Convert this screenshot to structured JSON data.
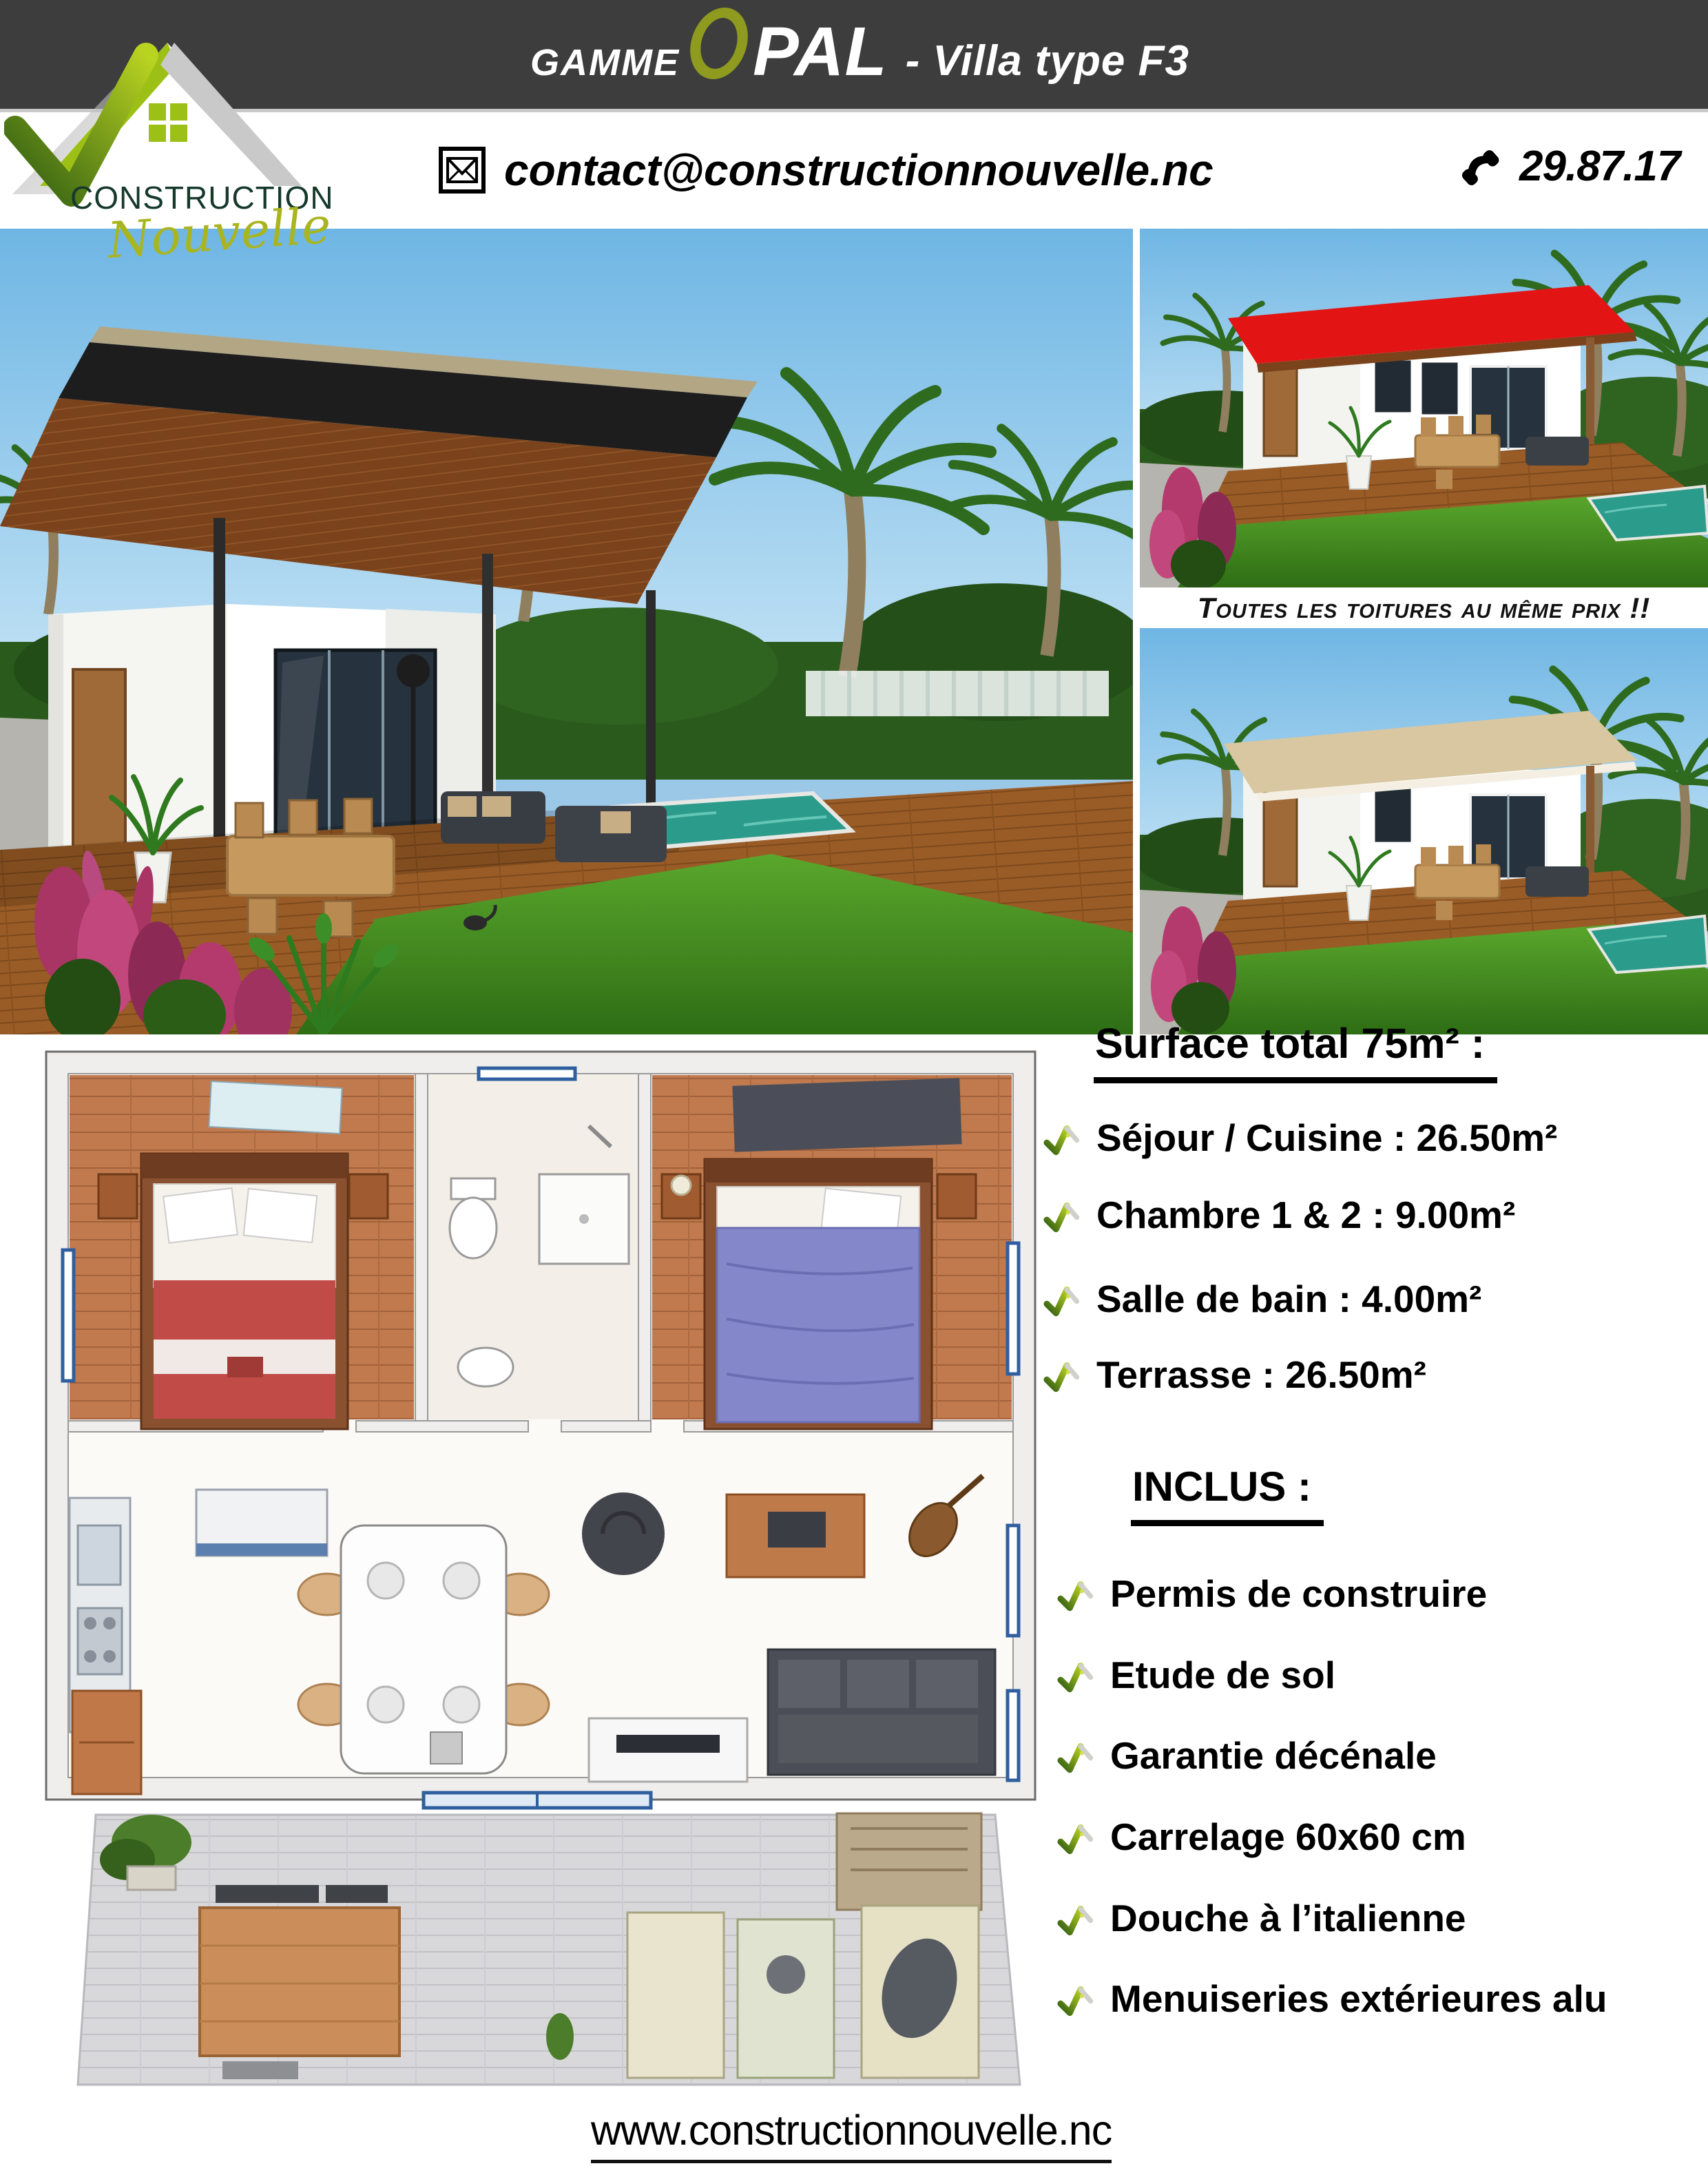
{
  "header": {
    "bg": "#3d3d3d",
    "gamme": "GAMME",
    "opal_o": "O",
    "opal_rest": "PAL",
    "subtitle": "- Villa type F3"
  },
  "brand": {
    "name_main": "CONSTRUCTION",
    "name_script": "Nouvelle",
    "email": "contact@constructionnouvelle.nc",
    "phone": "29.87.17",
    "website": "www.constructionnouvelle.nc"
  },
  "icons": {
    "email": "envelope-icon",
    "phone": "phone-receiver-icon",
    "list_bullet": "roof-check-icon",
    "logo": "green-roof-logo"
  },
  "banner": {
    "text": "Toutes les toitures au même prix !!"
  },
  "surface": {
    "heading": "Surface total 75m² :",
    "items": [
      "Séjour / Cuisine : 26.50m²",
      "Chambre 1 & 2 : 9.00m²",
      "Salle de bain : 4.00m²",
      "Terrasse : 26.50m²"
    ]
  },
  "inclus": {
    "heading": "INCLUS :",
    "items": [
      "Permis de construire",
      "Etude de sol",
      "Garantie décénale",
      "Carrelage 60x60 cm",
      "Douche à l’italienne",
      "Menuiseries extérieures alu"
    ]
  },
  "colors": {
    "accent_dark_green": "#2f5c12",
    "accent_bright_green": "#b9d321",
    "olive": "#8e9b1f",
    "roof_main": "#1d1d1d",
    "roof_red": "#e31414",
    "roof_tan": "#d8c7a0"
  }
}
